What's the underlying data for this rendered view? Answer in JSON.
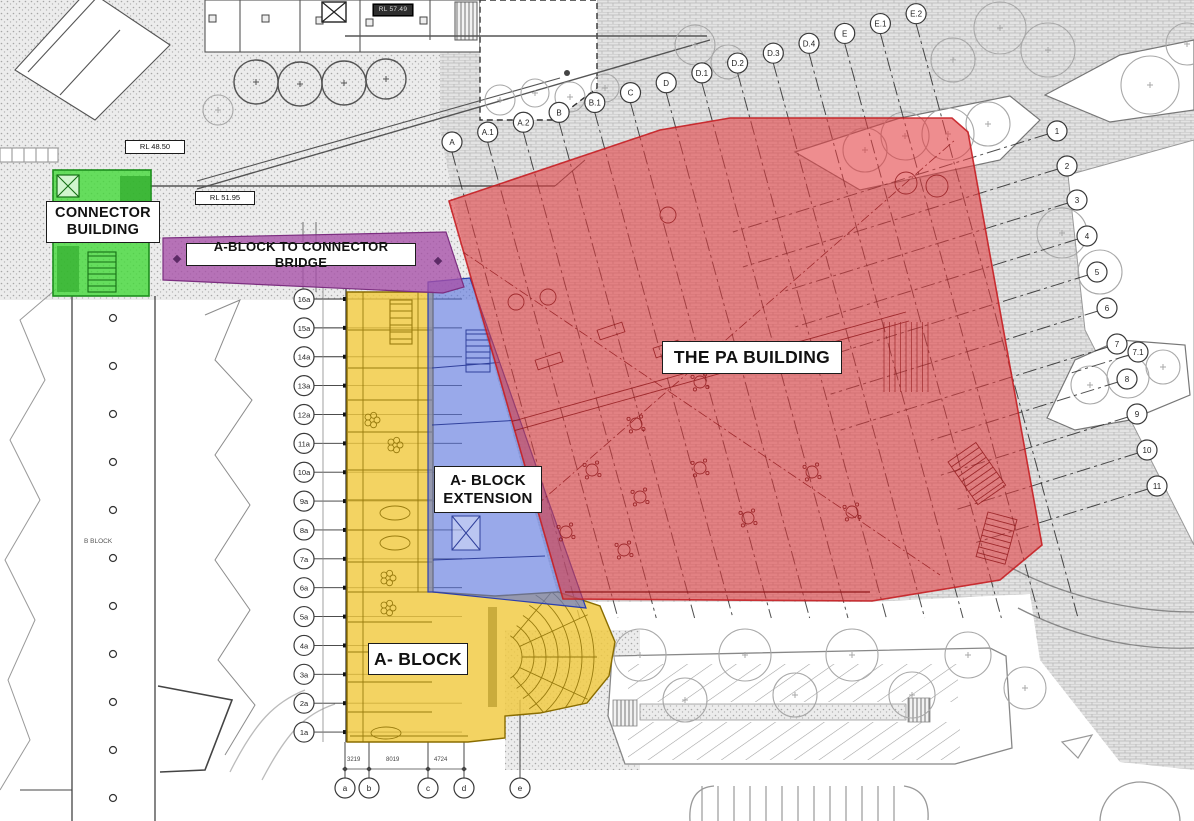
{
  "labels": {
    "connector_building": "CONNECTOR BUILDING",
    "bridge": "A-BLOCK TO CONNECTOR BRIDGE",
    "pa_building": "THE PA BUILDING",
    "a_block_extension": "A- BLOCK EXTENSION",
    "a_block": "A- BLOCK"
  },
  "annotations": {
    "rl_upper": "RL 48.50",
    "rl_lower": "RL 51.95",
    "rl_top": "RL 57.49",
    "b_block": "B BLOCK",
    "dim_ab": "3219",
    "dim_bc": "8019",
    "dim_cd": "4724"
  },
  "grid": {
    "left_labels": [
      "16a",
      "15a",
      "14a",
      "13a",
      "12a",
      "11a",
      "10a",
      "9a",
      "8a",
      "7a",
      "6a",
      "5a",
      "4a",
      "3a",
      "2a",
      "1a"
    ],
    "top_labels": [
      "A",
      "A.1",
      "A.2",
      "B",
      "B.1",
      "C",
      "D",
      "D.1",
      "D.2",
      "D.3",
      "D.4",
      "E",
      "E.1",
      "E.2"
    ],
    "right_labels": [
      "1",
      "2",
      "3",
      "4",
      "5",
      "6",
      "7",
      "7.1",
      "8",
      "9",
      "10",
      "11"
    ],
    "bottom_labels": [
      "a",
      "b",
      "c",
      "d",
      "e"
    ]
  },
  "colors": {
    "pa_red": "#e23b3e",
    "a_block_yellow": "#f0c93f",
    "extension_blue": "#5a74dd",
    "bridge_purple": "#a74fa8",
    "connector_green": "#44da39"
  }
}
